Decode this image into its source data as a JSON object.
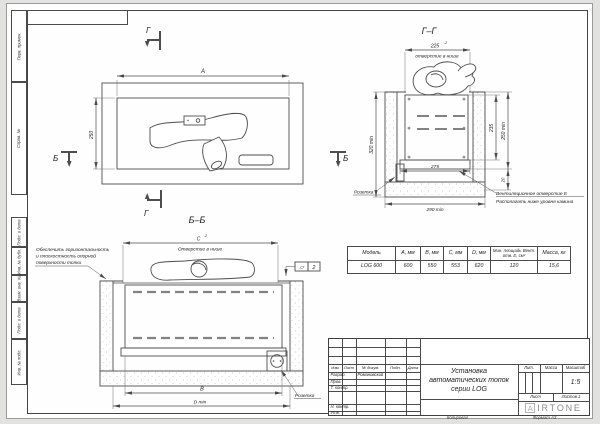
{
  "sheet": {
    "left_column_labels": [
      "Перв. примен.",
      "Справ. №",
      "Подп. и дата",
      "Инв. № дубл.",
      "Взам. инв. №",
      "Подп. и дата",
      "Инв. № подл."
    ],
    "copied": "Копировал",
    "format": "Формат А3"
  },
  "drawing": {
    "section_letter_g": "Г",
    "section_letter_b": "Б",
    "view_gg_label": "Г–Г",
    "view_bb_label": "Б–Б",
    "tolerance": "-2",
    "socket_label": "Розетка",
    "plan": {
      "width_dim": "А",
      "depth_dim": "250"
    },
    "gg": {
      "opening_dim": "225",
      "opening_note": "отверстие в нише",
      "height_dim": "320 min",
      "firebox_height_dim": "235",
      "depth_dim": "250 min",
      "gap_dim": "20",
      "base_dim": "275",
      "niche_depth_dim": "290 min",
      "vent_note_line1": "Вентиляционное отверстие Е",
      "vent_note_line2": "Располагать ниже уровня камина"
    },
    "bb": {
      "opening_dim": "С",
      "opening_note": "Отверстие в нише",
      "inner_width_dim": "В",
      "niche_width_dim": "D min",
      "note_line1": "Обеспечить горизонтальность",
      "note_line2": "и плоскостность опорной",
      "note_line3": "поверхности топки",
      "flatness_symbol": "▱",
      "flatness_value": "2"
    }
  },
  "spec_table": {
    "headers": [
      "Модель",
      "А, мм",
      "В, мм",
      "С, мм",
      "D, мм",
      "Мин. площадь Вент. отв. Е, см²",
      "Масса, кг"
    ],
    "row": [
      "LOG 600",
      "600",
      "550",
      "553",
      "620",
      "120",
      "15,6"
    ]
  },
  "title_block": {
    "change_header": [
      "Изм.",
      "Лист",
      "№ докум.",
      "Подп.",
      "Дата"
    ],
    "roles": [
      "Разраб.",
      "Пров.",
      "Т. контр.",
      "Н. контр.",
      "Утв."
    ],
    "developer_name": "Романовский",
    "title_line1": "Установка",
    "title_line2": "автоматических топок",
    "title_line3": "серии LOG",
    "lit_label": "Лит.",
    "mass_label": "Масса",
    "scale_label": "Масштаб",
    "scale_value": "1:5",
    "sheet_label": "Лист",
    "sheets_value": "Листов 1",
    "logo_a": "A",
    "logo_rest": "IRTONE"
  },
  "colors": {
    "line": "#4a4a4a",
    "speckle": "#bdbdbd",
    "logo_gray": "#8a8a8a"
  }
}
